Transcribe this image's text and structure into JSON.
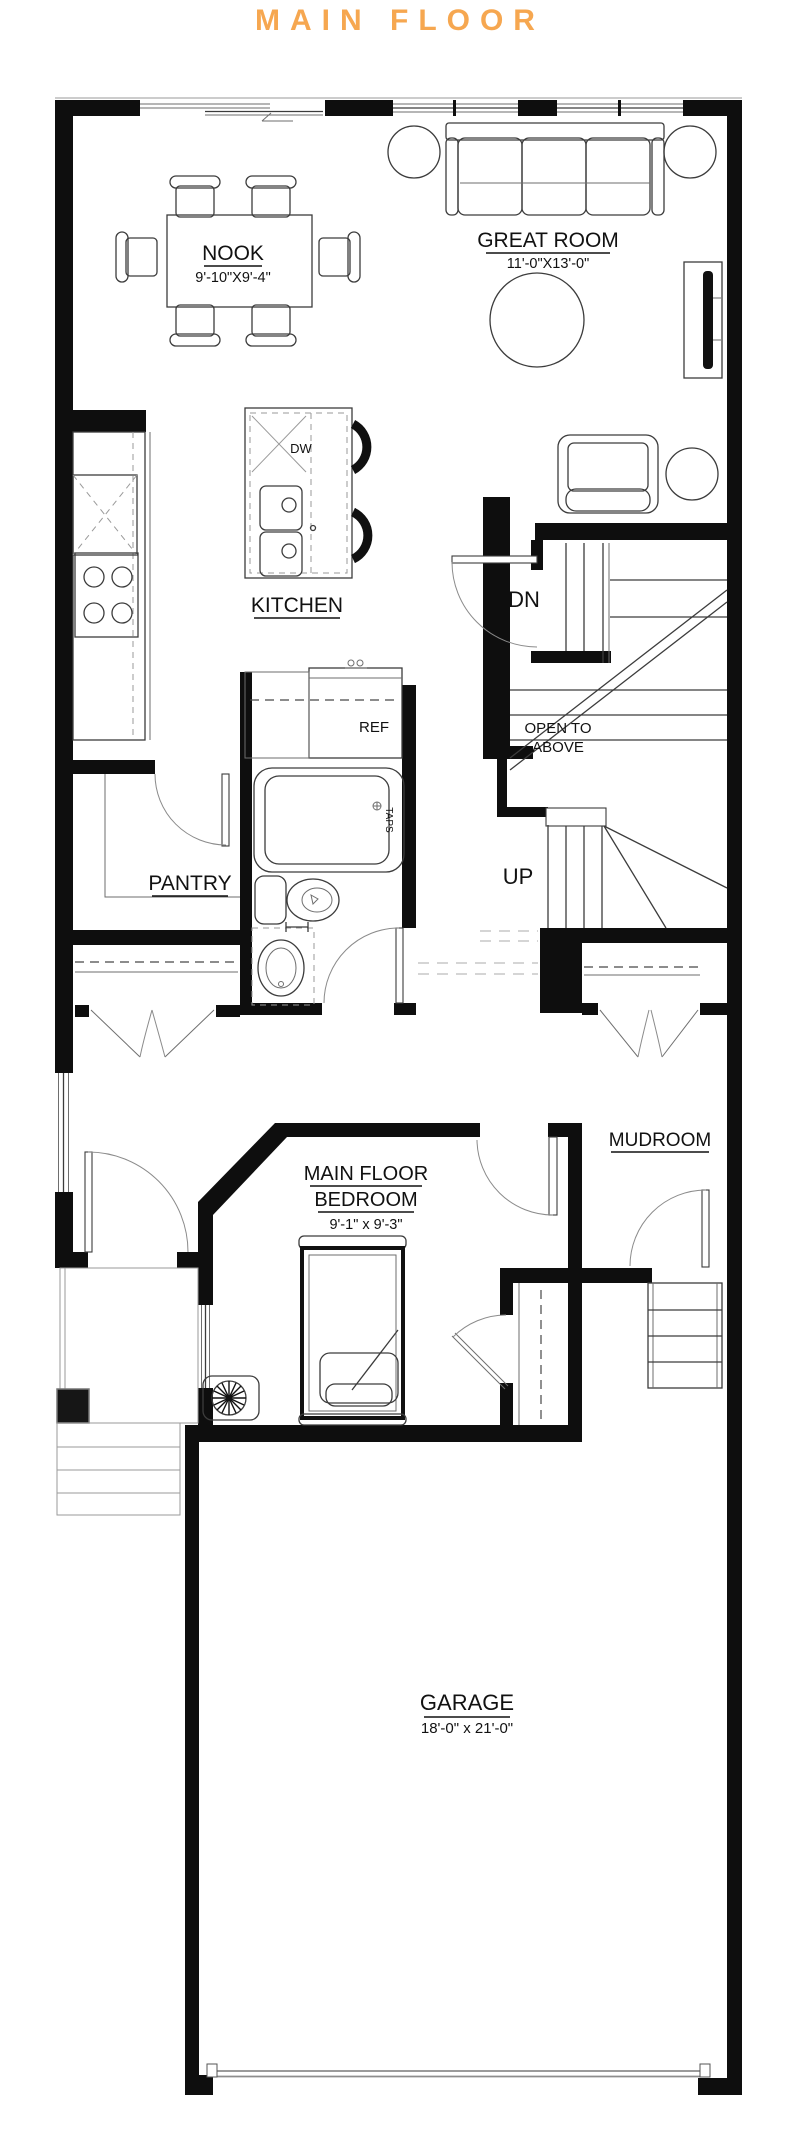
{
  "title": "MAIN FLOOR",
  "accent_color": "#F6A750",
  "rooms": {
    "nook": {
      "name": "NOOK",
      "dims": "9'-10\"X9'-4\""
    },
    "great_room": {
      "name": "GREAT ROOM",
      "dims": "11'-0\"X13'-0\""
    },
    "kitchen": {
      "name": "KITCHEN"
    },
    "pantry": {
      "name": "PANTRY"
    },
    "mudroom": {
      "name": "MUDROOM"
    },
    "main_floor_bedroom": {
      "name_line1": "MAIN FLOOR",
      "name_line2": "BEDROOM",
      "dims": "9'-1\" x 9'-3\""
    },
    "garage": {
      "name": "GARAGE",
      "dims": "18'-0\" x 21'-0\""
    }
  },
  "stairs": {
    "down_label": "DN",
    "up_label": "UP",
    "open_to_above_line1": "OPEN TO",
    "open_to_above_line2": "ABOVE"
  },
  "fixtures": {
    "dishwasher_label": "DW",
    "refrigerator_label": "REF",
    "tub_taps_label": "TAPS"
  }
}
